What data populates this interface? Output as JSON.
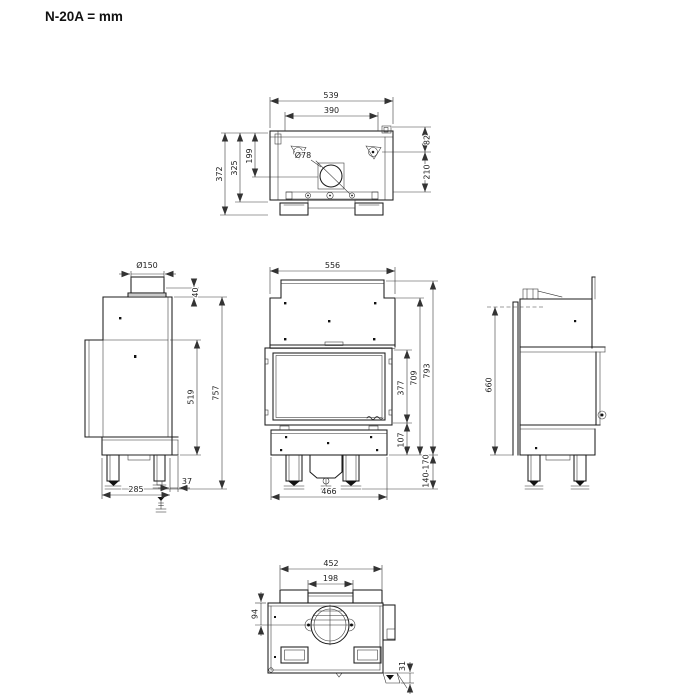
{
  "title": "N-20A = mm",
  "views": {
    "top": {
      "dims": {
        "width_total": "539",
        "width_inner": "390",
        "flue_diameter": "Ø78",
        "depth_flue_center": "199",
        "depth_body": "325",
        "depth_total": "372",
        "rear_offset": "82",
        "side_depth": "210"
      }
    },
    "left_side": {
      "dims": {
        "flue_pipe_diameter": "Ø150",
        "collar_height": "40",
        "height_total": "757",
        "glass_height": "519",
        "base_depth": "285",
        "rear_gap": "37"
      }
    },
    "front": {
      "dims": {
        "width_total": "556",
        "glass_height": "377",
        "base_height": "107",
        "body_height": "709",
        "height_total": "793",
        "leg_range": "140-170",
        "base_width": "466"
      }
    },
    "right_side": {
      "dims": {
        "height": "660"
      }
    },
    "bottom": {
      "dims": {
        "width_total": "452",
        "width_inner": "198",
        "intake_center": "94",
        "bracket": "31"
      }
    }
  }
}
